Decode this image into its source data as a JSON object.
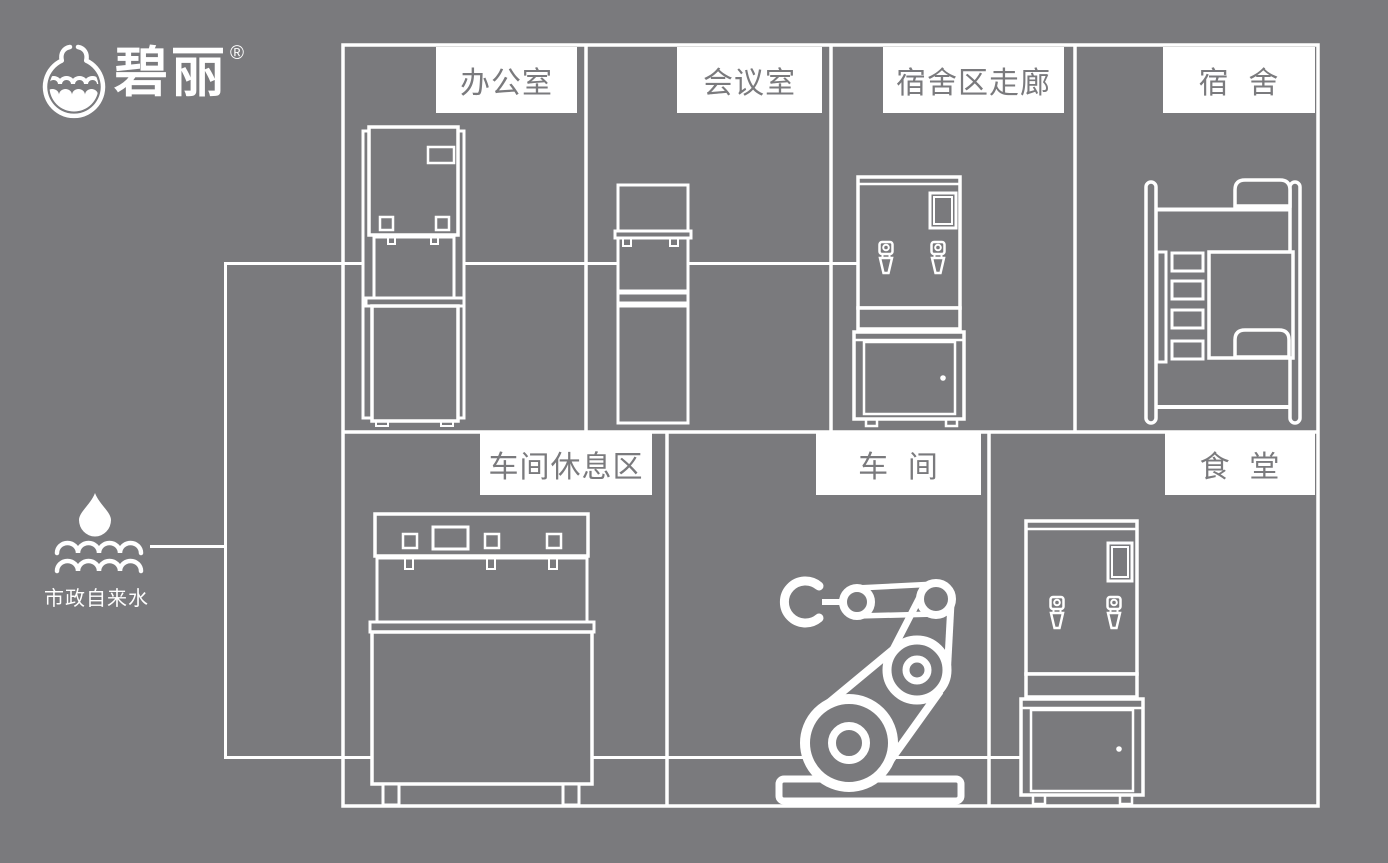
{
  "colors": {
    "background": "#7a7a7d",
    "line": "#ffffff",
    "label_background": "#ffffff",
    "label_text": "#7a7a7d"
  },
  "brand": {
    "name": "碧丽",
    "registered_mark": "®",
    "icon": "bili-water-cup-logo-icon"
  },
  "water_source": {
    "label": "市政自来水",
    "icon": "water-drop-over-waves-icon"
  },
  "rooms": [
    {
      "label": "办公室",
      "equipment_icon": "floor-standing-water-dispenser-icon"
    },
    {
      "label": "会议室",
      "equipment_icon": "slim-water-dispenser-icon"
    },
    {
      "label": "宿舍区走廊",
      "equipment_icon": "water-boiler-with-cabinet-icon"
    },
    {
      "label": "宿  舍",
      "equipment_icon": "bunk-bed-icon"
    },
    {
      "label": "车间休息区",
      "equipment_icon": "multi-tap-water-dispenser-icon"
    },
    {
      "label": "车  间",
      "equipment_icon": "robot-arm-icon"
    },
    {
      "label": "食  堂",
      "equipment_icon": "water-boiler-with-cabinet-icon"
    }
  ]
}
